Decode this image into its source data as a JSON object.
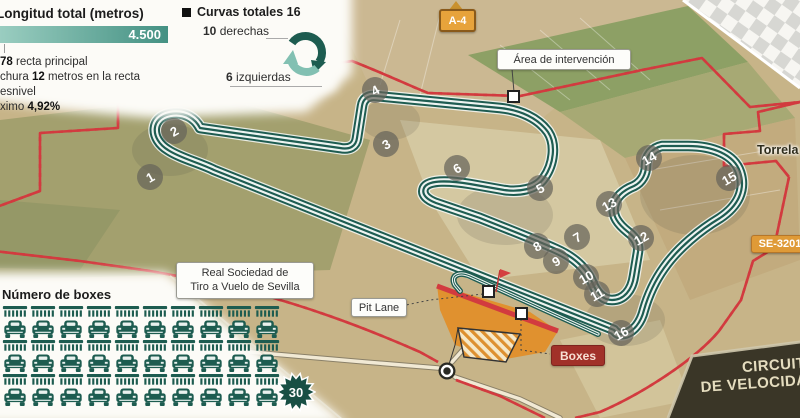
{
  "title_block": {
    "title": "Longitud total (metros)",
    "bar_value": "4.500",
    "notes": {
      "n1b": "78",
      "n1": " recta principal",
      "n2a": "chura ",
      "n2b": "12",
      "n2c": " metros en la recta",
      "n3": "esnivel",
      "n4a": "ximo ",
      "n4b": "4,92%"
    }
  },
  "curves_block": {
    "title": "Curvas totales 16",
    "right_bold": "10",
    "right_text": " derechas",
    "left_bold": "6",
    "left_text": " izquierdas"
  },
  "boxes_block": {
    "title": "Número de boxes",
    "count": 30,
    "badge": "30",
    "per_row": 10
  },
  "map": {
    "labels": {
      "area": "Área de intervención",
      "a4": "A-4",
      "torrela": "Torrela",
      "se_road": "SE-3201",
      "real1": "Real Sociedad de",
      "real2": "Tiro a Vuelo de Sevilla",
      "pit": "Pit Lane",
      "boxes": "Boxes"
    },
    "curve_markers": [
      {
        "n": 1,
        "x": 150,
        "y": 177
      },
      {
        "n": 2,
        "x": 174,
        "y": 131
      },
      {
        "n": 3,
        "x": 386,
        "y": 144
      },
      {
        "n": 4,
        "x": 375,
        "y": 90
      },
      {
        "n": 5,
        "x": 540,
        "y": 188
      },
      {
        "n": 6,
        "x": 457,
        "y": 168
      },
      {
        "n": 7,
        "x": 577,
        "y": 237
      },
      {
        "n": 8,
        "x": 537,
        "y": 246
      },
      {
        "n": 9,
        "x": 556,
        "y": 261
      },
      {
        "n": 10,
        "x": 586,
        "y": 277
      },
      {
        "n": 11,
        "x": 597,
        "y": 294
      },
      {
        "n": 12,
        "x": 641,
        "y": 238
      },
      {
        "n": 13,
        "x": 609,
        "y": 204
      },
      {
        "n": 14,
        "x": 649,
        "y": 158
      },
      {
        "n": 15,
        "x": 729,
        "y": 178
      },
      {
        "n": 16,
        "x": 621,
        "y": 333
      }
    ]
  },
  "footer": {
    "line1": "CIRCUITO",
    "line2": "DE VELOCIDAD"
  },
  "colors": {
    "track": "#1e5c51",
    "track_light": "#8fc4b6",
    "red": "#d23b3f",
    "orange": "#e0912f",
    "sign_orange": "#df9a37",
    "badge_green": "#184f44"
  }
}
